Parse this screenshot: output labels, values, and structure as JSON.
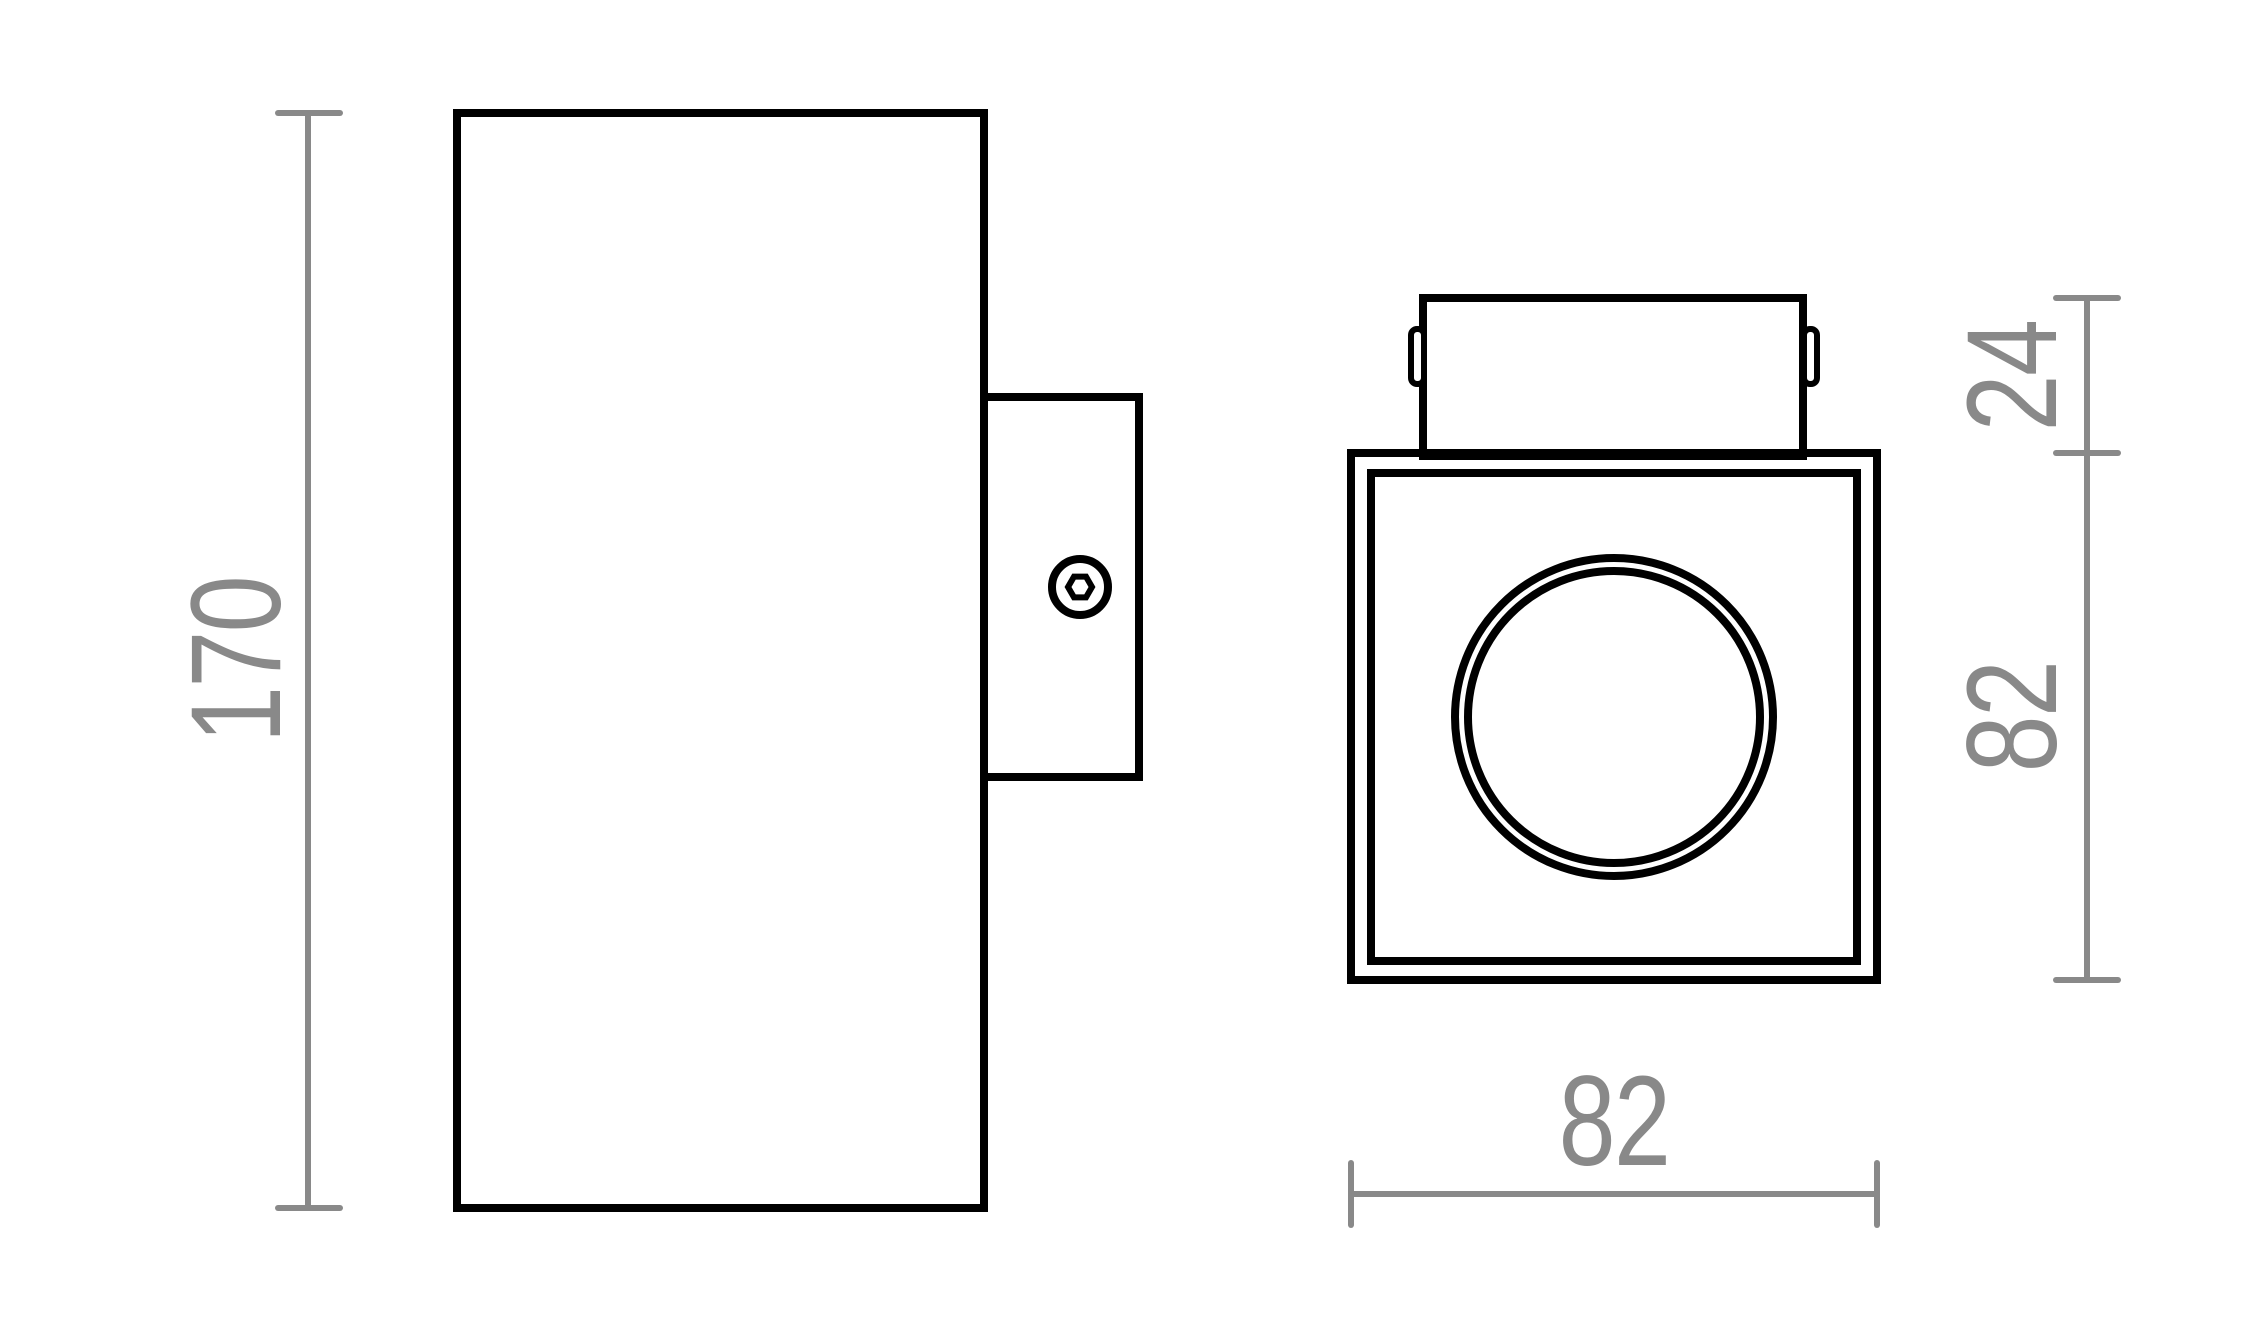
{
  "drawing": {
    "dimensions": {
      "body_height": {
        "label": "170"
      },
      "bracket_depth": {
        "label": "24"
      },
      "face_height": {
        "label": "82"
      },
      "face_width": {
        "label": "82"
      }
    },
    "colors": {
      "outline": "#000000",
      "dimension": "#898989",
      "background": "#ffffff"
    }
  }
}
